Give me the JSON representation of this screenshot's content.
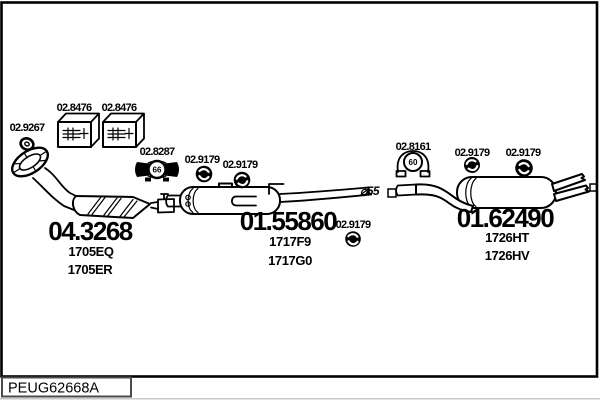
{
  "colors": {
    "ink": "#000000",
    "background": "#ffffff"
  },
  "footer": {
    "code": "PEUG62668A"
  },
  "parts": {
    "flange_gasket": {
      "ref": "02.9267"
    },
    "clamp_kit_left": {
      "ref": "02.8476"
    },
    "clamp_kit_right": {
      "ref": "02.8476"
    },
    "clamp_66": {
      "ref": "02.8287",
      "diameter": "66"
    },
    "hanger_mid_1": {
      "ref": "02.9179"
    },
    "hanger_mid_2": {
      "ref": "02.9179"
    },
    "hanger_mid_3": {
      "ref": "02.9179"
    },
    "clamp_60": {
      "ref": "02.8161",
      "diameter": "60"
    },
    "hanger_rear_1": {
      "ref": "02.9179"
    },
    "hanger_rear_2": {
      "ref": "02.9179"
    },
    "catalytic_converter": {
      "ref": "04.3268",
      "variant_1": "1705EQ",
      "variant_2": "1705ER"
    },
    "centre_silencer": {
      "ref": "01.55860",
      "variant_1": "1717F9",
      "variant_2": "1717G0"
    },
    "rear_silencer": {
      "ref": "01.62490",
      "variant_1": "1726HT",
      "variant_2": "1726HV"
    },
    "pipe_diameter": {
      "label": "⌀55"
    }
  }
}
